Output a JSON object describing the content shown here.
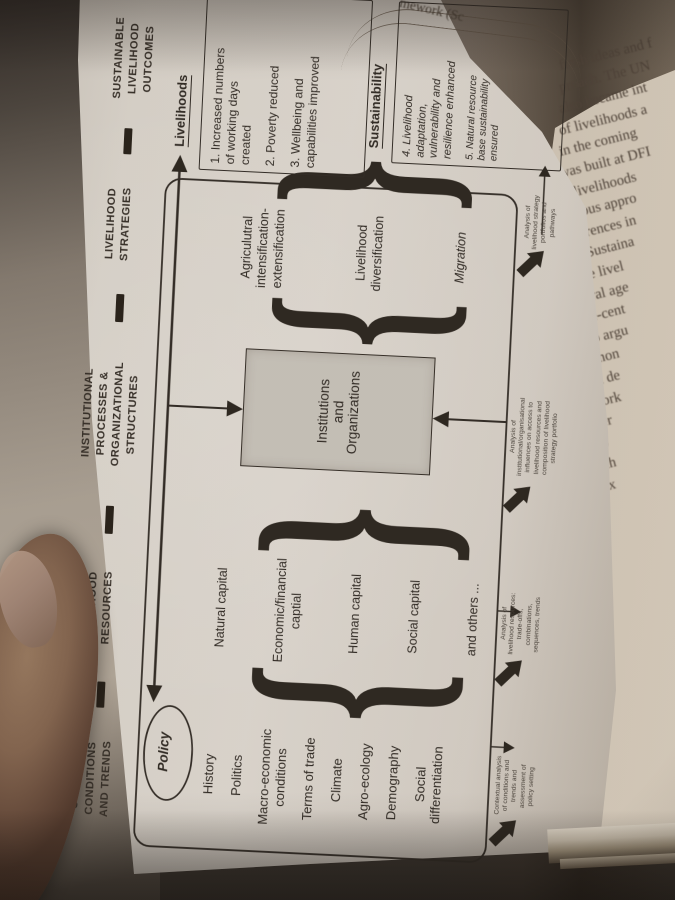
{
  "colors": {
    "background": "#37322d",
    "page": "#d9d4cc",
    "ink": "#2d2823",
    "institutions_box_fill": "#c7c3bb",
    "skin": "#82644f"
  },
  "caption_fragment": "mework (Sc",
  "diagram": {
    "headers": [
      "CONTEXTS\nCONDITIONS\nAND TRENDS",
      "LIVELIHOOD\nRESOURCES",
      "INSTITUTIONAL\nPROCESSES &\nORGANIZATIONAL\nSTRUCTURES",
      "LIVELIHOOD\nSTRATEGIES",
      "SUSTAINABLE\nLIVELIHOOD OUTCOMES"
    ],
    "contexts": {
      "policy": "Policy",
      "items": [
        "History",
        "Politics",
        "Macro-economic\nconditions",
        "Terms of trade",
        "Climate",
        "Agro-ecology",
        "Demography",
        "Social\ndifferentiation"
      ]
    },
    "resources": {
      "items": [
        "Natural capital",
        "Economic/financial\ncaptial",
        "Human capital",
        "Social capital",
        "and others ..."
      ]
    },
    "institutions": {
      "label": "Institutions\nand\nOrganizations"
    },
    "strategies": {
      "items": [
        "Agriculutral\nintensification-\nextensification",
        "Livelihood\ndiversification",
        "Migration"
      ]
    },
    "outcomes": {
      "livelihoods_heading": "Livelihoods",
      "livelihoods_items": [
        "1. Increased numbers\nof working days\ncreated",
        "2. Poverty reduced",
        "3. Wellbeing and\ncapabilities improved"
      ],
      "sustainability_heading": "Sustainability",
      "sustainability_items": [
        "4. Livelihood\nadaptation,\nvulnerability and\nresilience enhanced",
        "5. Natural resource\nbase sustainability\nensured"
      ]
    },
    "analysis_labels": [
      "Contextual analysis\nof conditions and\ntrends and\nassessment of\npolicy setting",
      "Analysis of\nlivelihood resources:\ntrade-offs,\ncombinations,\nsequences, trends",
      "Analysis of\ninstitutional/organisational\ninfluences on access to\nlivelihood resources and\ncomposition of livelihood\nstrategy portfolio",
      "Analysis of\nlivelihood strategy\nportfolios and\npathways"
    ]
  },
  "body_text": {
    "lines": [
      "fresh ideas and f",
      "proach. The UN",
      "also became int",
      "of livelihoods a",
      "in the coming",
      "was built at DFI",
      "in livelihoods",
      "various appro",
      "differences in",
      "“the Sustaina",
      "    The livel",
      "bilateral age",
      "people-cent",
      "little to argu",
      "much mon",
      "Internal de",
      "framework",
      "the wider",
      "    In sub",
      "the livelih",
      "In the nex",
      "the liveli",
      "conceptu",
      "to resear",
      "",
      "",
      "What is",
      "constra",
      "but the",
      "betwee",
      "herde",
      "strate",
      "econo",
      "    A",
      "1980",
      "of liv"
    ]
  }
}
